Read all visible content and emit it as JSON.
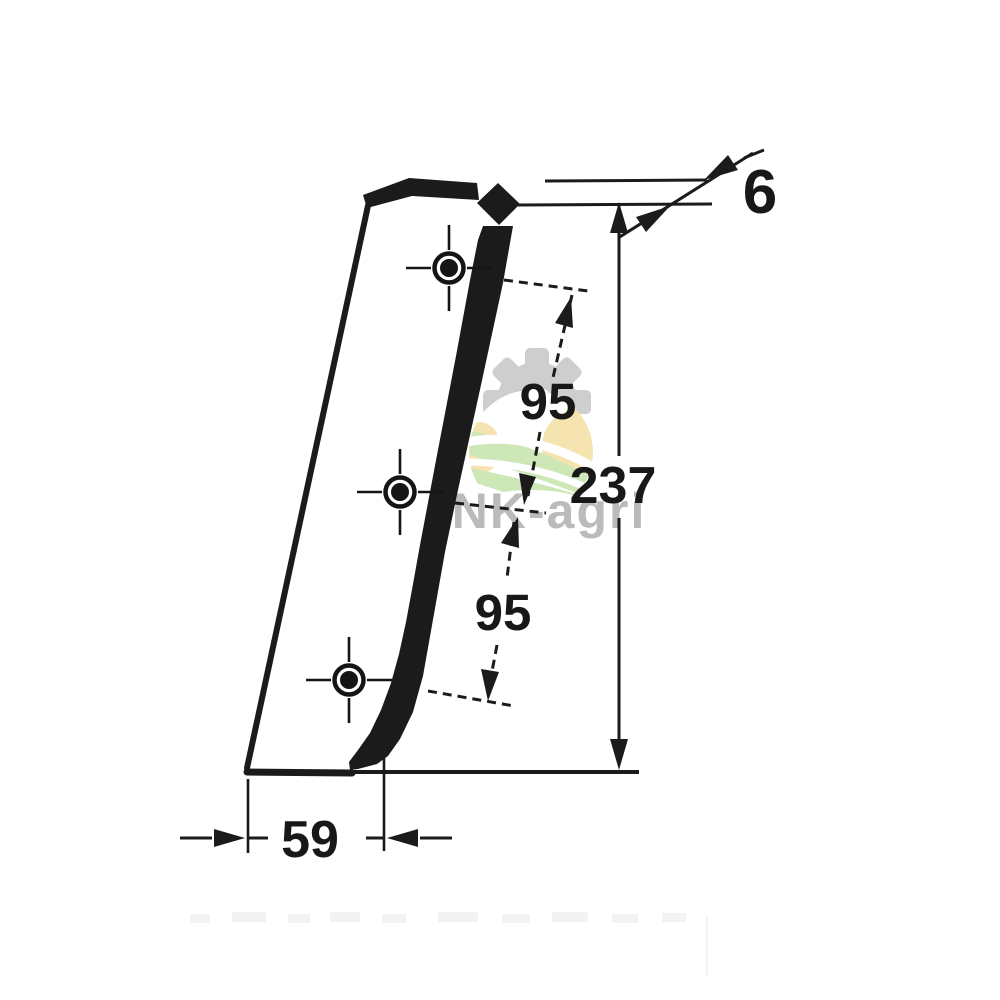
{
  "drawing": {
    "type": "technical-dimension-drawing",
    "subject": "slanted knife/blade plate with three cross-marked bolt holes",
    "line_color": "#1b1b1b",
    "labels": {
      "thickness": "6",
      "overall_height": "237",
      "hole_spacing_top": "95",
      "hole_spacing_bottom": "95",
      "base_width": "59"
    },
    "holes_count": 3
  },
  "watermark": {
    "text": "UNK-agri",
    "text_color": "#b4b4b4",
    "gear_color": "#c9c9c9",
    "field_green": "#c8e6af",
    "field_tan": "#f5e0a8"
  }
}
